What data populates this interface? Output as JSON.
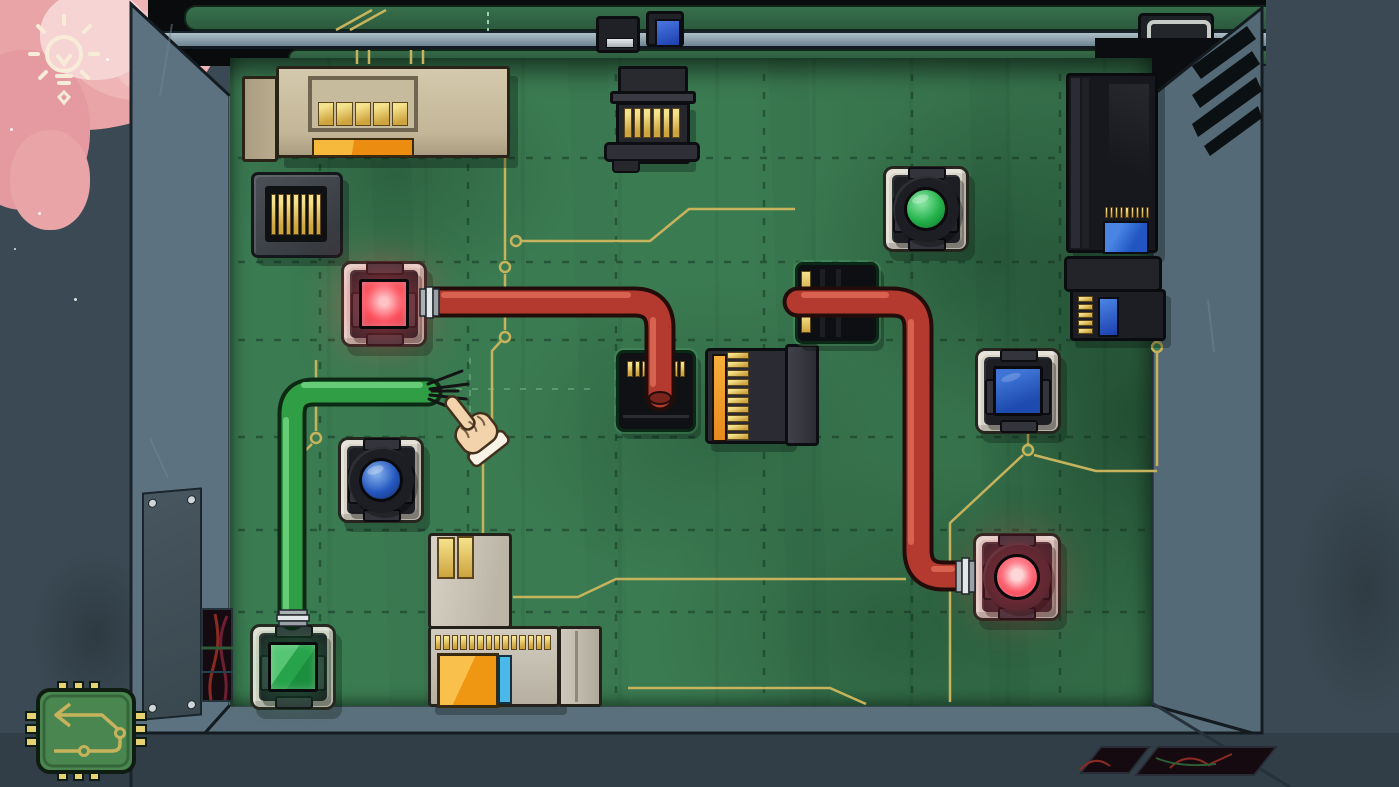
{
  "scene": {
    "name": "circuit-box-puzzle-room",
    "description": "Top-down view into a box containing a green circuit board puzzle with lamps, buttons, sockets and cables"
  },
  "hud": {
    "hint_button": {
      "icon": "lightbulb-icon"
    },
    "undo_button": {
      "icon": "chip-arrow-icon"
    }
  },
  "board": {
    "modules": [
      {
        "id": "tan-supply-module",
        "kind": "beige box with 5 gold pins and orange bar"
      },
      {
        "id": "gold-pin-socket",
        "kind": "dark socket with 7 gold pins"
      },
      {
        "id": "top-pin-connector",
        "kind": "black connector with 6 gold pins"
      },
      {
        "id": "black-socket-center",
        "kind": "black socket, red cable plugged in"
      },
      {
        "id": "card-edge-connector",
        "kind": "black connector with gold pin column and orange stripe"
      },
      {
        "id": "black-socket-right",
        "kind": "black socket, red cable passes through"
      },
      {
        "id": "dark-module-tall",
        "kind": "black module with pin row and blue label"
      },
      {
        "id": "dark-module-small",
        "kind": "black module with pin column and blue label"
      },
      {
        "id": "gray-l-module",
        "kind": "gray L-shaped module with gold pins, orange window, cyan stripe"
      },
      {
        "id": "silver-slot-module",
        "kind": "small wall component with silver slot"
      },
      {
        "id": "blue-chip-module",
        "kind": "small wall component with blue chip"
      },
      {
        "id": "silver-frame-module",
        "kind": "wall component with silver frame"
      }
    ],
    "lights": [
      {
        "id": "red-square-lamp",
        "shape": "square",
        "color": "red",
        "lit": true
      },
      {
        "id": "green-square-lamp",
        "shape": "square",
        "color": "green",
        "lit": true
      },
      {
        "id": "blue-round-button",
        "shape": "round",
        "color": "blue",
        "lit": false
      },
      {
        "id": "green-round-button",
        "shape": "round",
        "color": "green",
        "lit": false
      },
      {
        "id": "blue-square-button",
        "shape": "square",
        "color": "blue",
        "lit": false
      },
      {
        "id": "red-round-button",
        "shape": "round",
        "color": "red",
        "lit": true
      }
    ],
    "cables": [
      {
        "id": "red-cable-left",
        "color": "red",
        "from": "red-square-lamp",
        "to": "black-socket-center"
      },
      {
        "id": "red-cable-right",
        "color": "red",
        "from": "black-socket-right",
        "to": "red-round-button"
      },
      {
        "id": "green-cable",
        "color": "green",
        "from": "green-square-lamp",
        "to": "loose-frayed-end"
      }
    ],
    "cursor": {
      "type": "pointing-hand",
      "near": "frayed green cable end"
    }
  },
  "colors": {
    "outer_wall": "#3a4953",
    "outer_wall_dark": "#313e48",
    "wall": "#5c7280",
    "wall_right": "#546a77",
    "floor": "#5a707c",
    "board": "#3b7b52",
    "gold": "#c7b35c",
    "pin_gold": "#e7d272",
    "cable_red": "#b43a30",
    "cable_red_dark": "#230d0a",
    "cable_red_hi": "#dd6a55",
    "cable_green": "#2f9e44",
    "cable_green_dark": "#0c2913",
    "cable_green_hi": "#6ccf7c",
    "plate": "#d9d4c8",
    "bezel": "#1d1e23",
    "bezel_hi": "#34353c",
    "lens_red_sq": "#fc4a58",
    "lens_red_core": "#ffc3c6",
    "lens_green_sq": "#2aa84f",
    "lens_blue_round": "#2457bf",
    "lens_green_round": "#23b14b",
    "lens_blue_sq": "#1d4bb0",
    "lens_red_round": "#fc4053",
    "tan": "#cdc1a4",
    "orange": "#f09c1c",
    "blue_label": "#2f6fd8",
    "metal": "#d6dbdd",
    "silver_bar": "#9fb2bb",
    "cloud": "#e8a4a7",
    "cream": "#f6ecd8",
    "skin": "#f2d3ab"
  }
}
